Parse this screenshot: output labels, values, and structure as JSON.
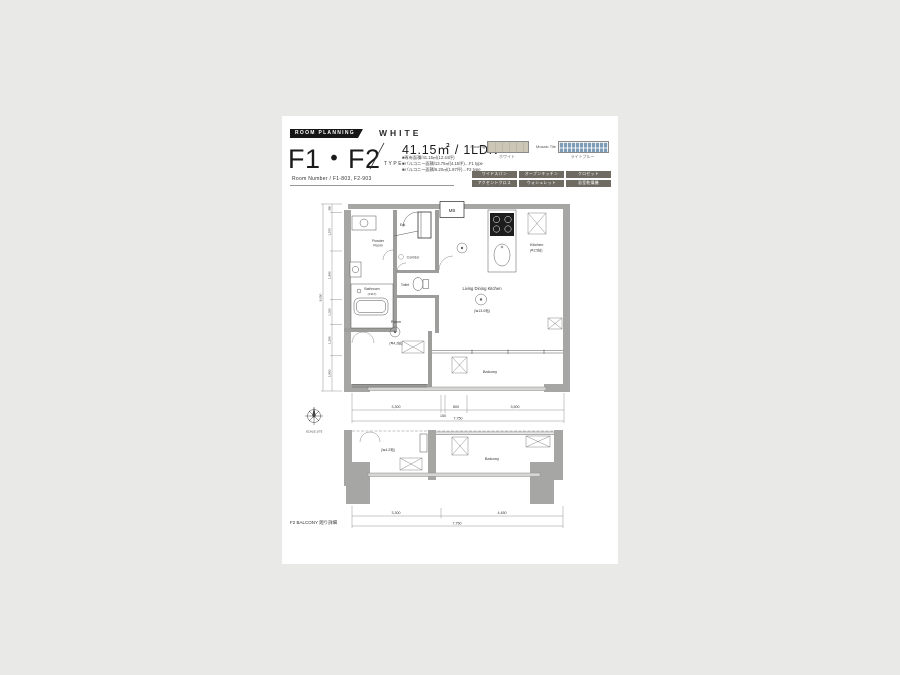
{
  "page": {
    "background": "#e9e9e7",
    "paper": "#ffffff"
  },
  "header": {
    "badge": "ROOM PLANNING",
    "color_scheme": "WHITE",
    "plan_code": "F1・F2",
    "plan_code_suffix": "TYPE",
    "area_summary": "41.15㎡ / 1LDK",
    "notes": [
      "■専有面積/41.15㎡(12.44坪)",
      "■バルコニー面積/13.75㎡(4.15坪)…F1 type",
      "■バルコニー面積/6.20㎡(1.87坪)…F2 type"
    ],
    "room_number": "Room Number / F1-803, F2-903"
  },
  "finishes": {
    "flooring_label": "Flooring",
    "flooring_name": "ホワイト",
    "flooring_color": "#cbc6b6",
    "tile_label": "Mosaic Tile",
    "tile_name": "ライトブルー",
    "tile_color": "#7d9cb8",
    "features": [
      "ワイドスパン",
      "オープンキッチン",
      "クロゼット",
      "アクセントクロス",
      "ウォシュレット",
      "浴室乾燥機"
    ]
  },
  "main_plan": {
    "labels": {
      "mb": "MB",
      "ent": "Ent.",
      "powder_line1": "Powder",
      "powder_line2": "Room",
      "bathroom": "Bathroom",
      "bathroom_size": "(1317)",
      "toilet": "Toilet",
      "corridor": "Corridor",
      "kitchen": "Kitchen",
      "kitchen_size": "(≒2.5帖)",
      "ldk": "Living Dining Kitchen",
      "ldk_size": "(≒13.0帖)",
      "room": "Room",
      "room_size": "(≒4.2帖)",
      "balcony": "Balcony"
    },
    "dims_bottom": [
      "3,300",
      "150",
      "800",
      "3,500"
    ],
    "dims_bottom_total": "7,750",
    "dims_left": [
      "350",
      "1,570",
      "1,980",
      "1,020",
      "1,280",
      "1,850"
    ],
    "dims_left_total": "8,050",
    "scale_label": "SCALE 1/75"
  },
  "f2_plan": {
    "caption": "F2 BALCONY 廻り詳細",
    "room_size": "(≒4.2帖)",
    "balcony": "Balcony",
    "dims": [
      "3,300",
      "4,450"
    ],
    "dims_total": "7,750"
  }
}
